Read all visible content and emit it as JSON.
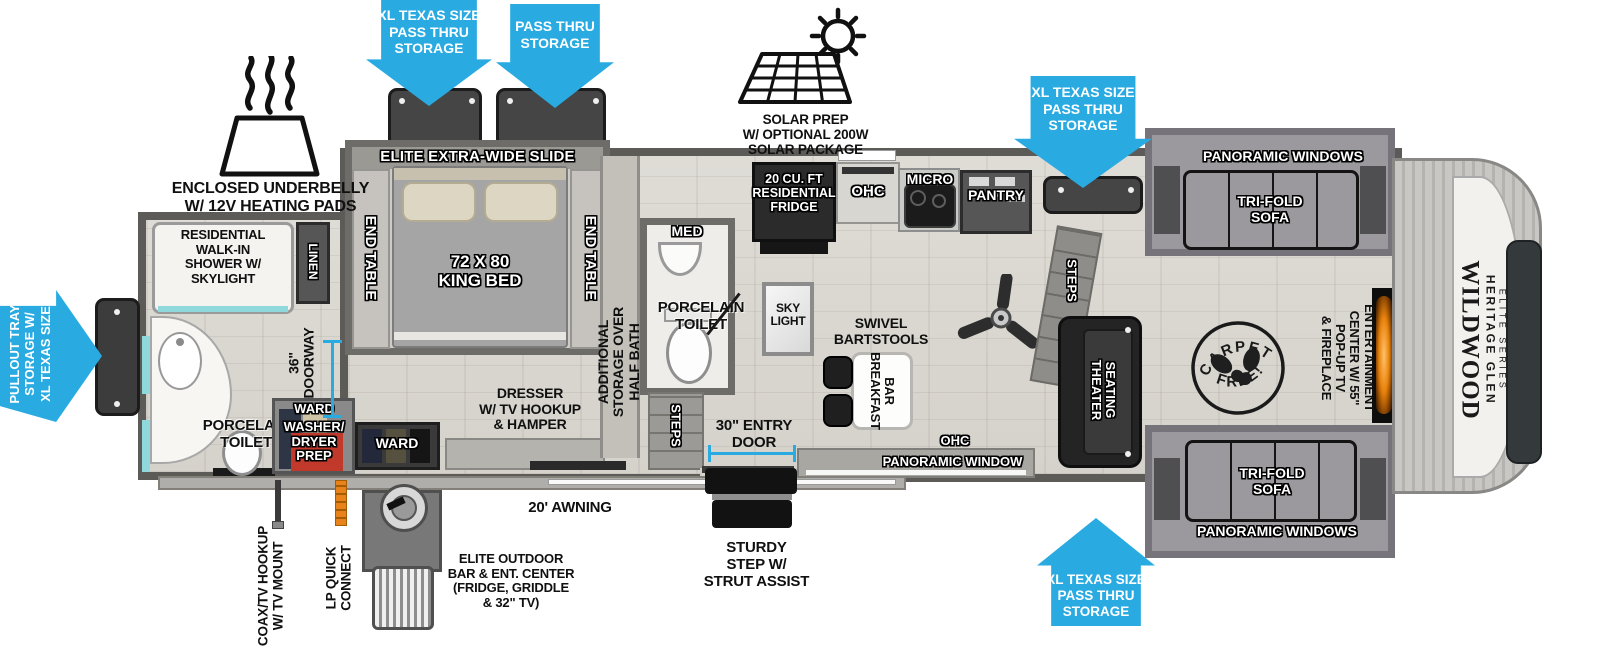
{
  "colors": {
    "arrow_blue": "#29ABE2",
    "fireplace_orange": "#E8820C",
    "dryer_red": "#C0392B",
    "accent_cyan": "#8FD8DC"
  },
  "arrows": {
    "top_left": "XL TEXAS SIZE\nPASS THRU\nSTORAGE",
    "top_mid": "PASS THRU\nSTORAGE",
    "top_right": "XL TEXAS SIZE\nPASS THRU\nSTORAGE",
    "bottom_right": "XL TEXAS SIZE\nPASS THRU\nSTORAGE",
    "left_lines": [
      "XL TEXAS SIZE",
      "STORAGE W/",
      "PULLOUT TRAY"
    ]
  },
  "features": {
    "underbelly": "ENCLOSED UNDERBELLY\nW/ 12V HEATING PADS",
    "solar": "SOLAR PREP\nW/ OPTIONAL 200W\nSOLAR PACKAGE"
  },
  "bedroom": {
    "slide_header": "ELITE EXTRA-WIDE SLIDE",
    "end_table_left": "END TABLE",
    "end_table_right": "END TABLE",
    "king_bed": "72 X 80\nKING BED",
    "dresser": "DRESSER\nW/ TV HOOKUP\n& HAMPER",
    "ward_front": "WARD",
    "additional_storage": "ADDITIONAL\nSTORAGE OVER\nHALF BATH"
  },
  "rear_bath": {
    "shower": "RESIDENTIAL\nWALK-IN\nSHOWER W/\nSKYLIGHT",
    "linen": "LINEN",
    "doorway": "36\"\nDOORWAY",
    "porcelain_toilet": "PORCELAIN\nTOILET",
    "ward": "WARD",
    "washer_dryer": "WASHER/\nDRYER\nPREP"
  },
  "half_bath": {
    "med": "MED",
    "porcelain_toilet": "PORCELAIN\nTOILET",
    "skylight": "SKY\nLIGHT",
    "steps": "STEPS"
  },
  "kitchen": {
    "fridge": "20 CU. FT\nRESIDENTIAL\nFRIDGE",
    "ohc": "OHC",
    "micro": "MICRO",
    "pantry": "PANTRY",
    "barstools": "SWIVEL\nBARTSTOOLS",
    "breakfast_bar_lines": [
      "BREAKFAST",
      "BAR"
    ]
  },
  "living": {
    "steps": "STEPS",
    "theater_lines": [
      "THEATER",
      "SEATING"
    ],
    "sofa_top": "TRI-FOLD\nSOFA",
    "sofa_bottom": "TRI-FOLD\nSOFA",
    "windows_top": "PANORAMIC WINDOWS",
    "windows_bottom": "PANORAMIC WINDOWS",
    "ohc": "OHC",
    "window_wall": "PANORAMIC WINDOW",
    "entertainment": "ENTERTAINMENT\nCENTER W/ 55\"\nPOP-UP TV\n& FIREPLACE",
    "carpet_top": "CARPET",
    "carpet_bottom": "FREE!"
  },
  "exterior": {
    "entry_door": "30\" ENTRY\nDOOR",
    "awning": "20' AWNING",
    "step": "STURDY\nSTEP W/\nSTRUT ASSIST",
    "outdoor_bar": "ELITE OUTDOOR\nBAR & ENT. CENTER\n(FRIDGE, GRIDDLE\n& 32\" TV)",
    "coax": "COAX/TV HOOKUP\nW/ TV MOUNT",
    "lp": "LP QUICK\nCONNECT"
  },
  "logo": {
    "brand": "WILDWOOD",
    "series": "HERITAGE GLEN",
    "trim": "ELITE SERIES"
  }
}
